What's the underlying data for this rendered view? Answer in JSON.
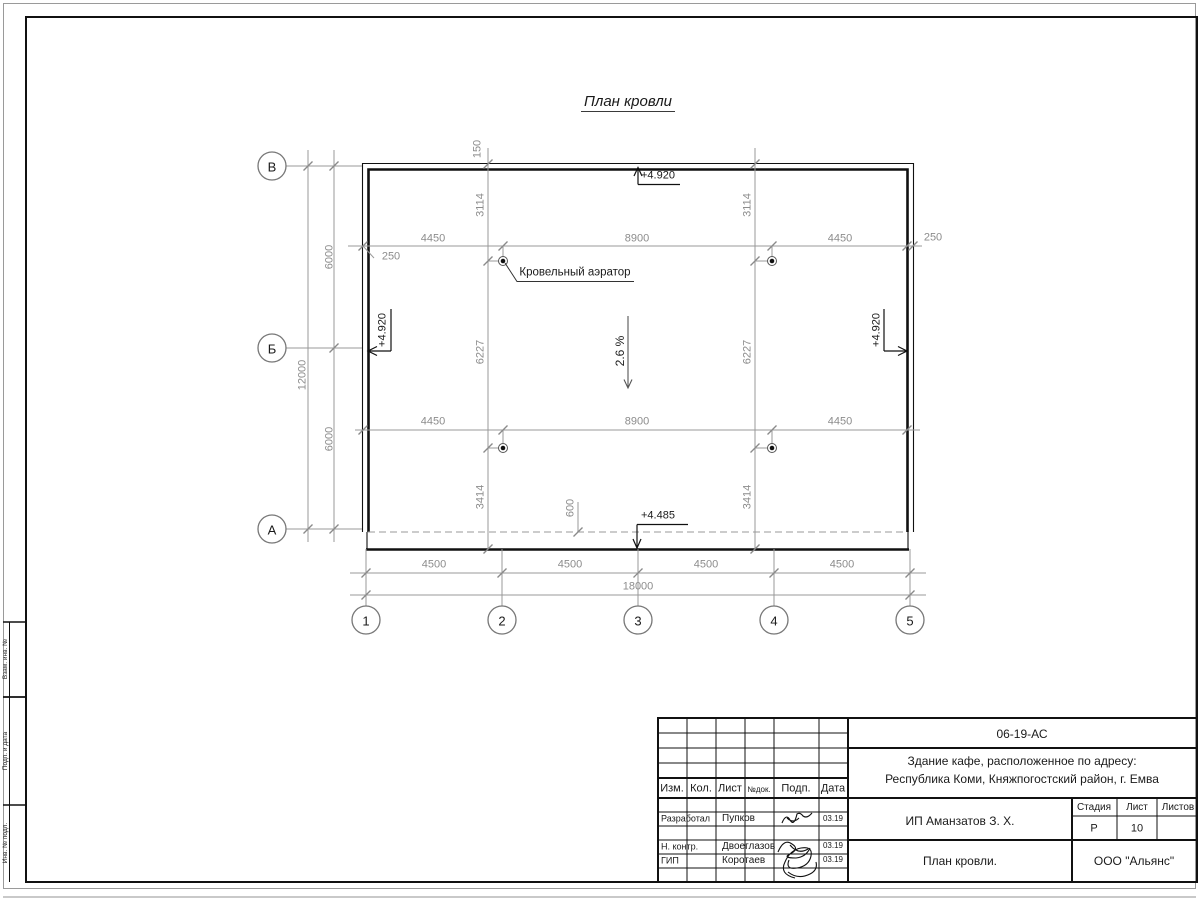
{
  "drawing": {
    "title": "План кровли",
    "slope_label": "2.6 %",
    "aerator_label": "Кровельный аэратор",
    "elevation_top": "+4.920",
    "elevation_left": "+4.920",
    "elevation_right": "+4.920",
    "elevation_bottom": "+4.485",
    "axis_letters": [
      "В",
      "Б",
      "А"
    ],
    "axis_numbers": [
      "1",
      "2",
      "3",
      "4",
      "5"
    ],
    "dims": {
      "d150": "150",
      "d250": "250",
      "d3114": "3114",
      "d4450": "4450",
      "d8900": "8900",
      "d6000": "6000",
      "d12000": "12000",
      "d6227": "6227",
      "d3414": "3414",
      "d600": "600",
      "d4500": "4500",
      "d18000": "18000"
    }
  },
  "titleblock": {
    "doc_number": "06-19-АС",
    "object_line1": "Здание кафе, расположенное по адресу:",
    "object_line2": "Республика Коми, Княжпогостский район, г. Емва",
    "client": "ИП Аманзатов З. Х.",
    "sheet_title": "План кровли.",
    "company": "ООО \"Альянс\"",
    "header": {
      "izm": "Изм.",
      "kol": "Кол.",
      "list": "Лист",
      "ndok": "№док.",
      "podp": "Подп.",
      "data": "Дата"
    },
    "stage_label": "Стадия",
    "sheet_label": "Лист",
    "sheets_label": "Листов",
    "stage_value": "Р",
    "sheet_value": "10",
    "rows": [
      {
        "role": "Разработал",
        "name": "Пупков",
        "date": "03.19"
      },
      {
        "role": "Н. контр.",
        "name": "Двоеглазов",
        "date": "03.19"
      },
      {
        "role": "ГИП",
        "name": "Коротаев",
        "date": "03.19"
      }
    ]
  },
  "margin_labels": {
    "top": "Взам. инв. №",
    "middle": "Подп. и дата",
    "bottom": "Инв. № подл."
  }
}
